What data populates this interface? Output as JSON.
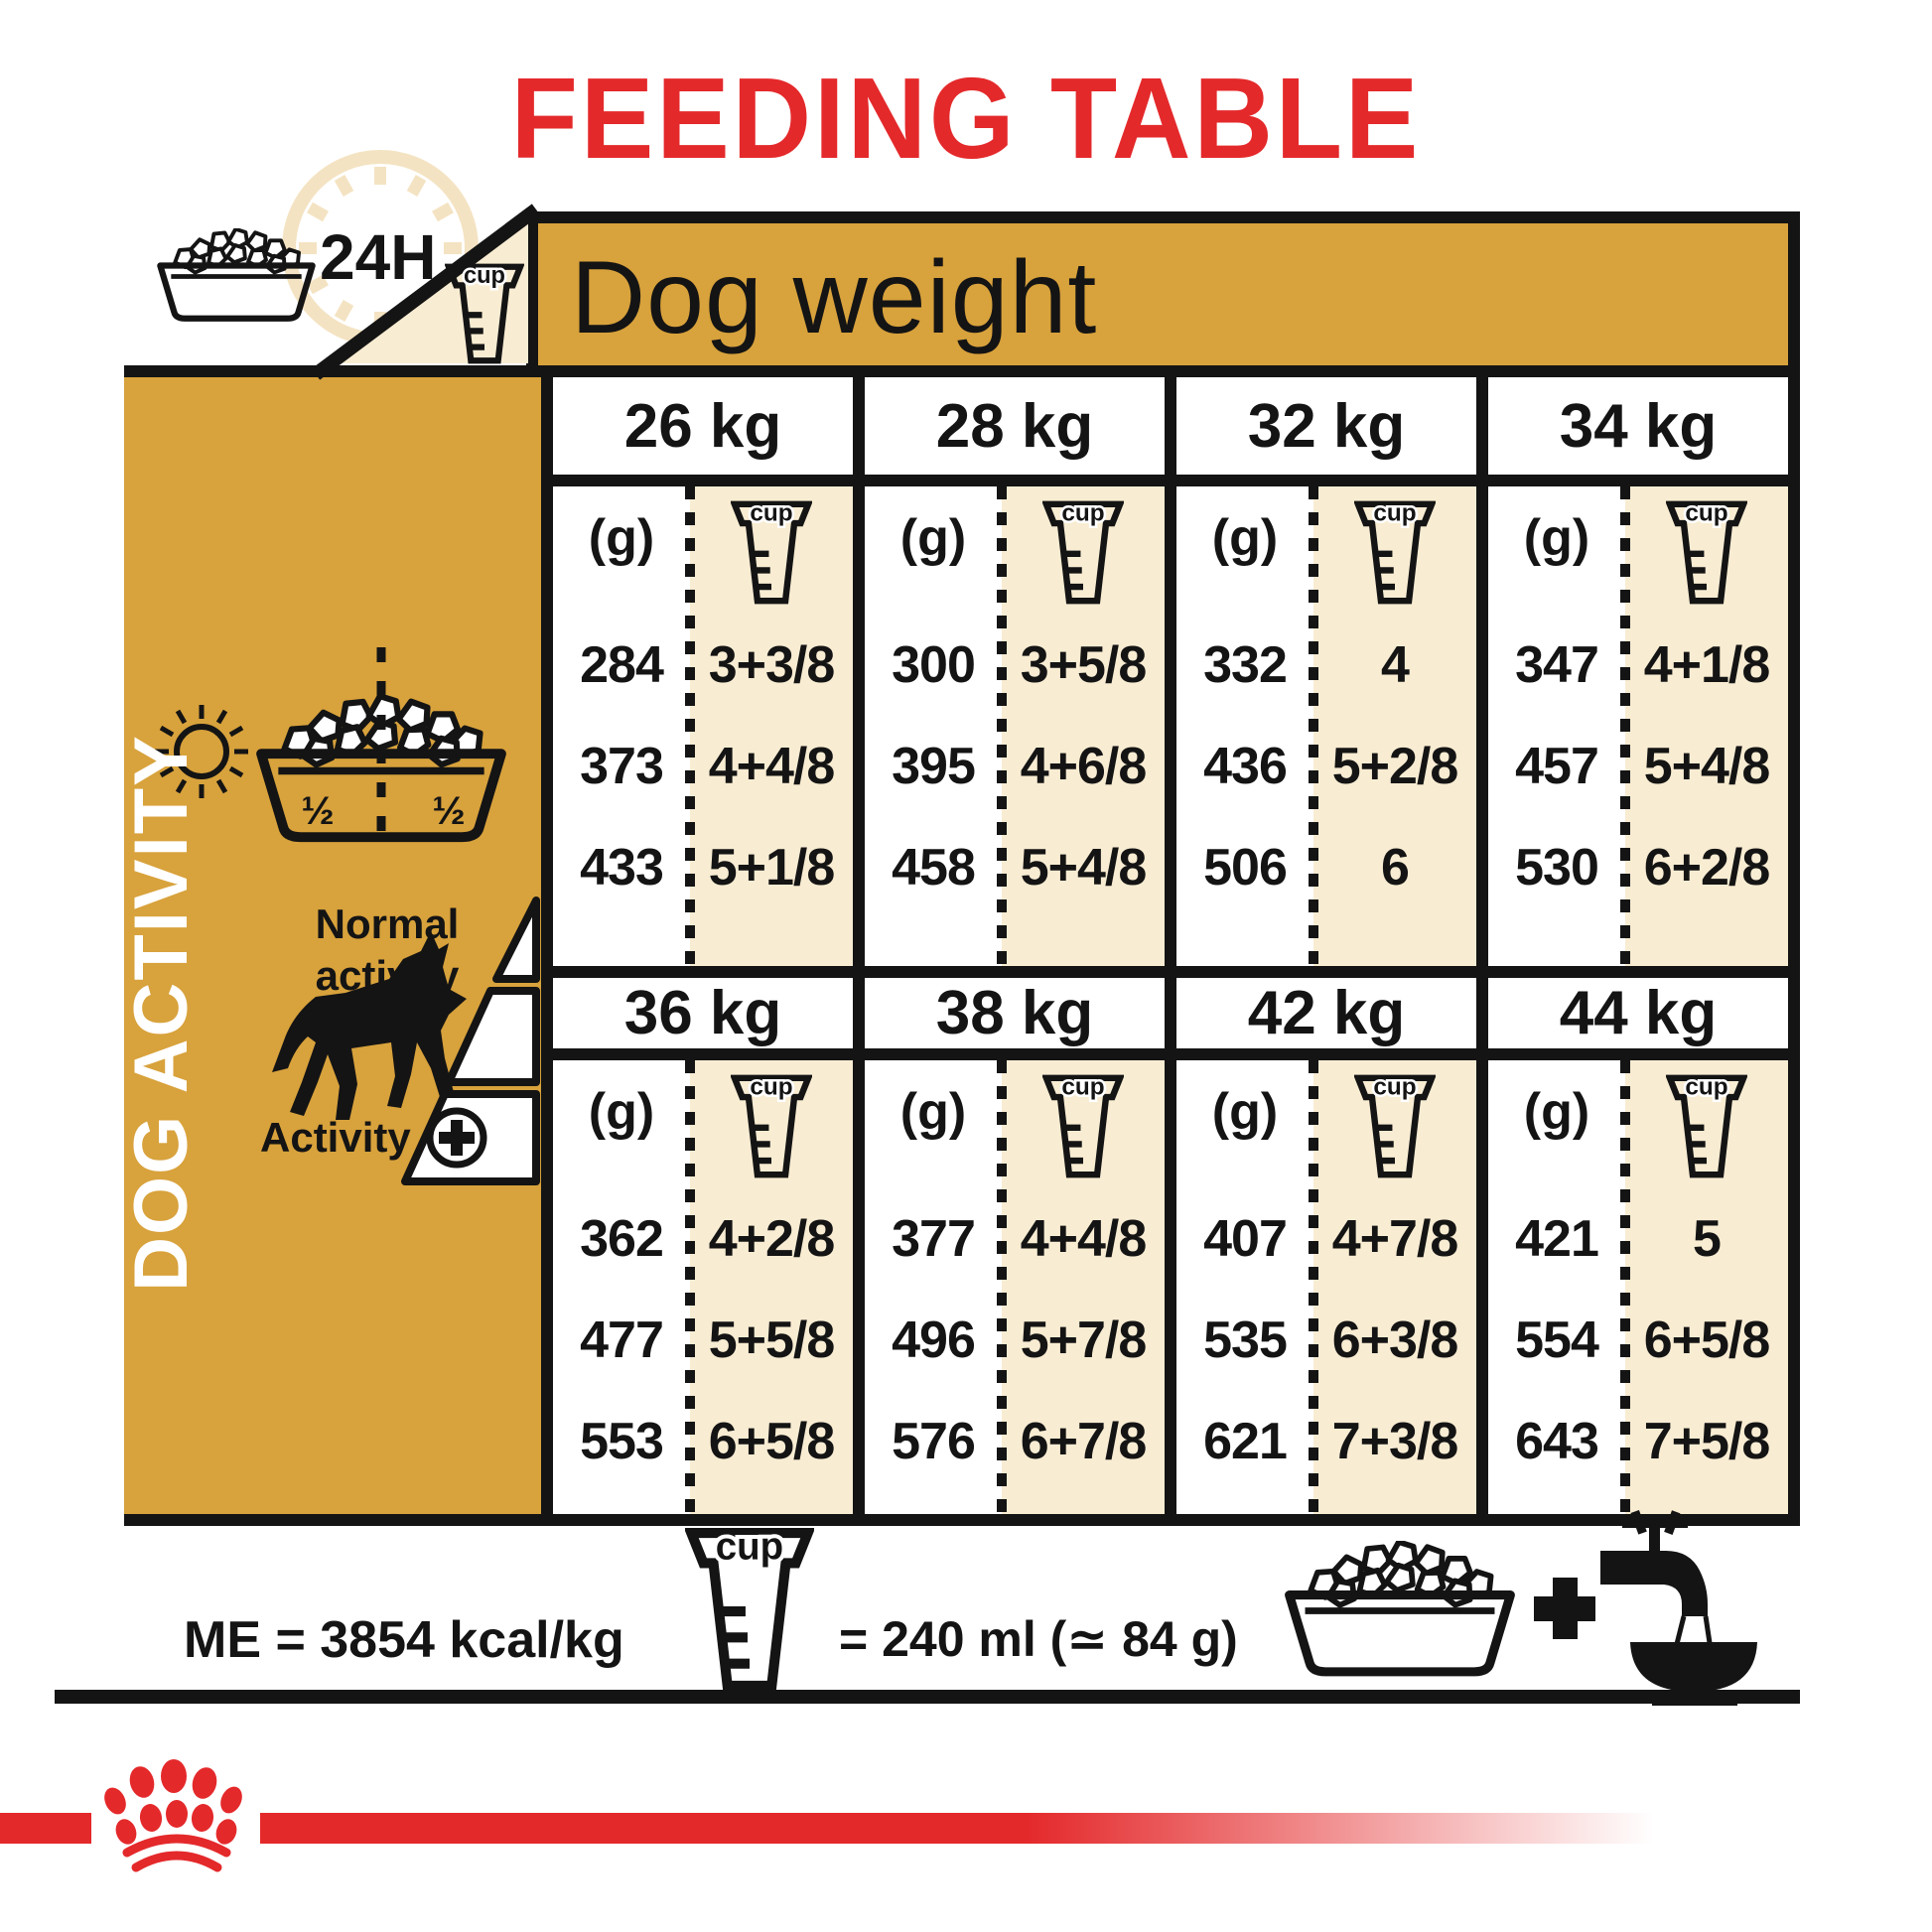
{
  "title": "FEEDING TABLE",
  "header": {
    "dog_weight_label": "Dog weight",
    "duration_label": "24H"
  },
  "sidebar": {
    "vertical_label": "DOG ACTIVITY",
    "normal_activity_label": "Normal activity",
    "activity_label": "Activity",
    "half_left": "½",
    "half_right": "½"
  },
  "icons": {
    "cup_label": "cup"
  },
  "table": {
    "grams_header": "(g)",
    "groups": [
      {
        "columns": [
          {
            "weight": "26 kg",
            "rows": [
              {
                "g": "284",
                "cup": "3+3/8"
              },
              {
                "g": "373",
                "cup": "4+4/8"
              },
              {
                "g": "433",
                "cup": "5+1/8"
              }
            ]
          },
          {
            "weight": "28 kg",
            "rows": [
              {
                "g": "300",
                "cup": "3+5/8"
              },
              {
                "g": "395",
                "cup": "4+6/8"
              },
              {
                "g": "458",
                "cup": "5+4/8"
              }
            ]
          },
          {
            "weight": "32 kg",
            "rows": [
              {
                "g": "332",
                "cup": "4"
              },
              {
                "g": "436",
                "cup": "5+2/8"
              },
              {
                "g": "506",
                "cup": "6"
              }
            ]
          },
          {
            "weight": "34 kg",
            "rows": [
              {
                "g": "347",
                "cup": "4+1/8"
              },
              {
                "g": "457",
                "cup": "5+4/8"
              },
              {
                "g": "530",
                "cup": "6+2/8"
              }
            ]
          }
        ]
      },
      {
        "columns": [
          {
            "weight": "36 kg",
            "rows": [
              {
                "g": "362",
                "cup": "4+2/8"
              },
              {
                "g": "477",
                "cup": "5+5/8"
              },
              {
                "g": "553",
                "cup": "6+5/8"
              }
            ]
          },
          {
            "weight": "38 kg",
            "rows": [
              {
                "g": "377",
                "cup": "4+4/8"
              },
              {
                "g": "496",
                "cup": "5+7/8"
              },
              {
                "g": "576",
                "cup": "6+7/8"
              }
            ]
          },
          {
            "weight": "42 kg",
            "rows": [
              {
                "g": "407",
                "cup": "4+7/8"
              },
              {
                "g": "535",
                "cup": "6+3/8"
              },
              {
                "g": "621",
                "cup": "7+3/8"
              }
            ]
          },
          {
            "weight": "44 kg",
            "rows": [
              {
                "g": "421",
                "cup": "5"
              },
              {
                "g": "554",
                "cup": "6+5/8"
              },
              {
                "g": "643",
                "cup": "7+5/8"
              }
            ]
          }
        ]
      }
    ]
  },
  "footer": {
    "me_label": "ME = 3854 kcal/kg",
    "cup_equiv_label": "= 240 ml (≃ 84 g)"
  },
  "colors": {
    "gold": "#D8A23C",
    "cream": "#F8ECD2",
    "red": "#E4292B",
    "black": "#141414"
  }
}
